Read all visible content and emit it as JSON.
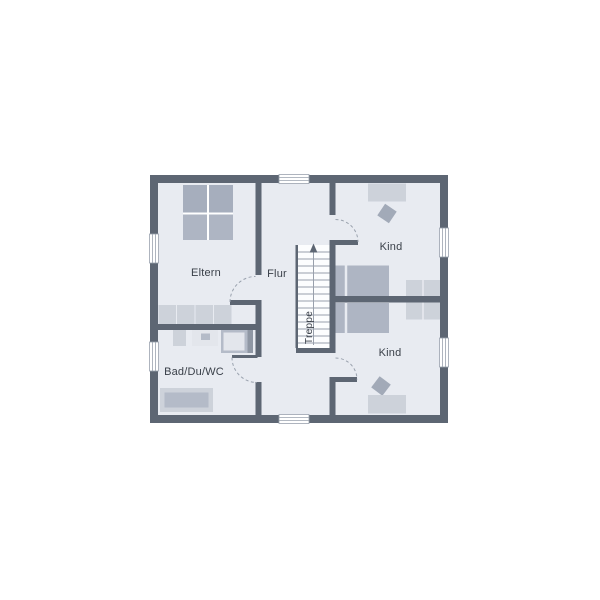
{
  "plan": {
    "type": "floor_plan_upper_storey",
    "colors": {
      "background": "#ffffff",
      "wall": "#5d6673",
      "floor": "#e8ebf1",
      "line": "#9aa2ae",
      "stair_tread": "#99a0ac",
      "stair_fill": "#fcfdfe",
      "text": "#3a4049",
      "bed": "#aeb5c3",
      "bed_dark": "#a6aebd",
      "furniture_light": "#cdd2da",
      "fixture_inner": "#b4bbc8",
      "fixture_bright": "#e3e6ec",
      "fixture_edge": "#8f97a4",
      "chair": "#a2aab8",
      "white_line": "#ffffff"
    },
    "rooms": [
      {
        "id": "eltern",
        "label": "Eltern"
      },
      {
        "id": "flur",
        "label": "Flur"
      },
      {
        "id": "kind-top",
        "label": "Kind"
      },
      {
        "id": "kind-bottom",
        "label": "Kind"
      },
      {
        "id": "bad-du-wc",
        "label": "Bad/Du/WC"
      }
    ],
    "stairs": {
      "label": "Treppe"
    }
  }
}
